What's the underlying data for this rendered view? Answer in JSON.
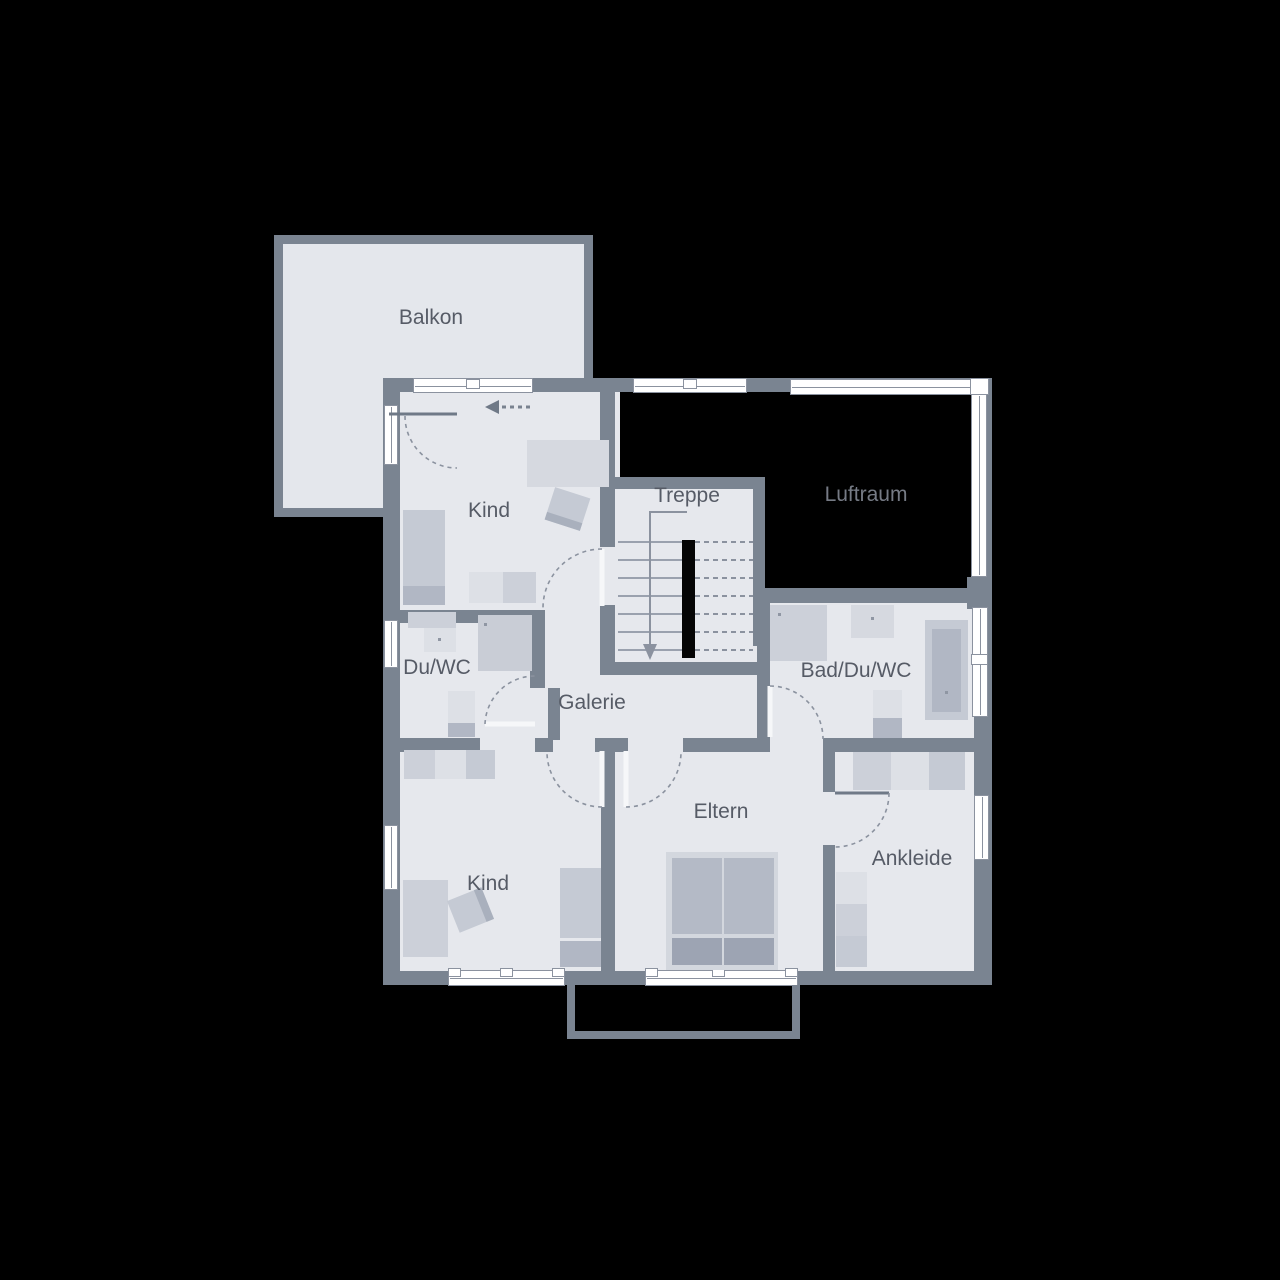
{
  "plan": {
    "type": "floor-plan",
    "floor_shown": "upper floor with gallery and void over living area"
  },
  "colors": {
    "wall": "#7a8491",
    "floor": "#e6e8ed",
    "floor-balcony": "#e4e7ec",
    "glass": "#ffffff",
    "glass-frame": "#8b929f",
    "fur-light": "#dde0e6",
    "fur-mid": "#ccd0d9",
    "fur-mid2": "#c5cad4",
    "fur-dark": "#b1b7c4",
    "fur-darker": "#9da4b3",
    "label-text": "#565b66",
    "luftraum-text": "#767b85",
    "void": "#000000"
  },
  "rooms": {
    "balkon": {
      "label": "Balkon"
    },
    "kind_upper": {
      "label": "Kind"
    },
    "treppe": {
      "label": "Treppe"
    },
    "luftraum": {
      "label": "Luftraum"
    },
    "duwc": {
      "label": "Du/WC"
    },
    "galerie": {
      "label": "Galerie"
    },
    "bad": {
      "label": "Bad/Du/WC"
    },
    "eltern": {
      "label": "Eltern"
    },
    "kind_lower": {
      "label": "Kind"
    },
    "ankleide": {
      "label": "Ankleide"
    }
  }
}
